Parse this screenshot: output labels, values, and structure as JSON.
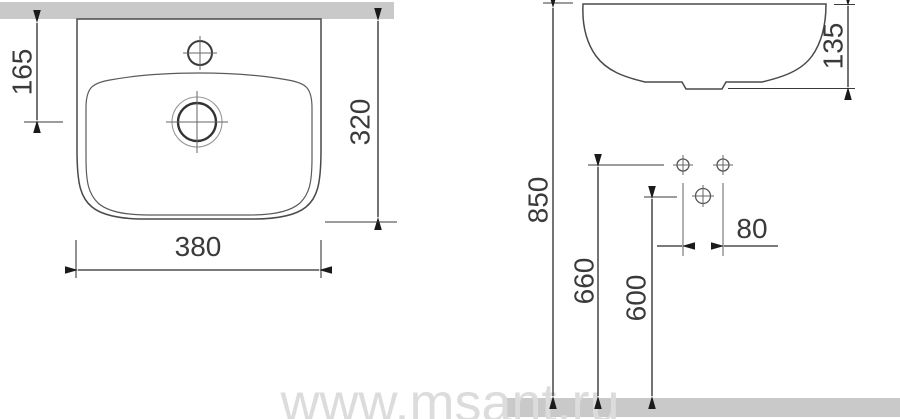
{
  "page": {
    "title": "Washbasin installation technical drawing",
    "background": "#ffffff"
  },
  "watermark": {
    "text": "www.msant.ru",
    "color": "#dcdcdc"
  },
  "colors": {
    "surface_gray": "#c9c9c9",
    "outline": "#4a4a4a",
    "dimension_line": "#2a2a2a",
    "label_text": "#3a3a3a"
  },
  "top_view": {
    "description": "washbasin plan view against wall",
    "labels": {
      "tap_hole_offset": "165",
      "depth": "320",
      "width": "380"
    }
  },
  "front_view": {
    "description": "washbasin side profile with installation heights",
    "labels": {
      "basin_height": "135",
      "rim_height": "850",
      "drain_height": "660",
      "fixing_height": "600",
      "fixing_hole_spacing": "80"
    }
  }
}
